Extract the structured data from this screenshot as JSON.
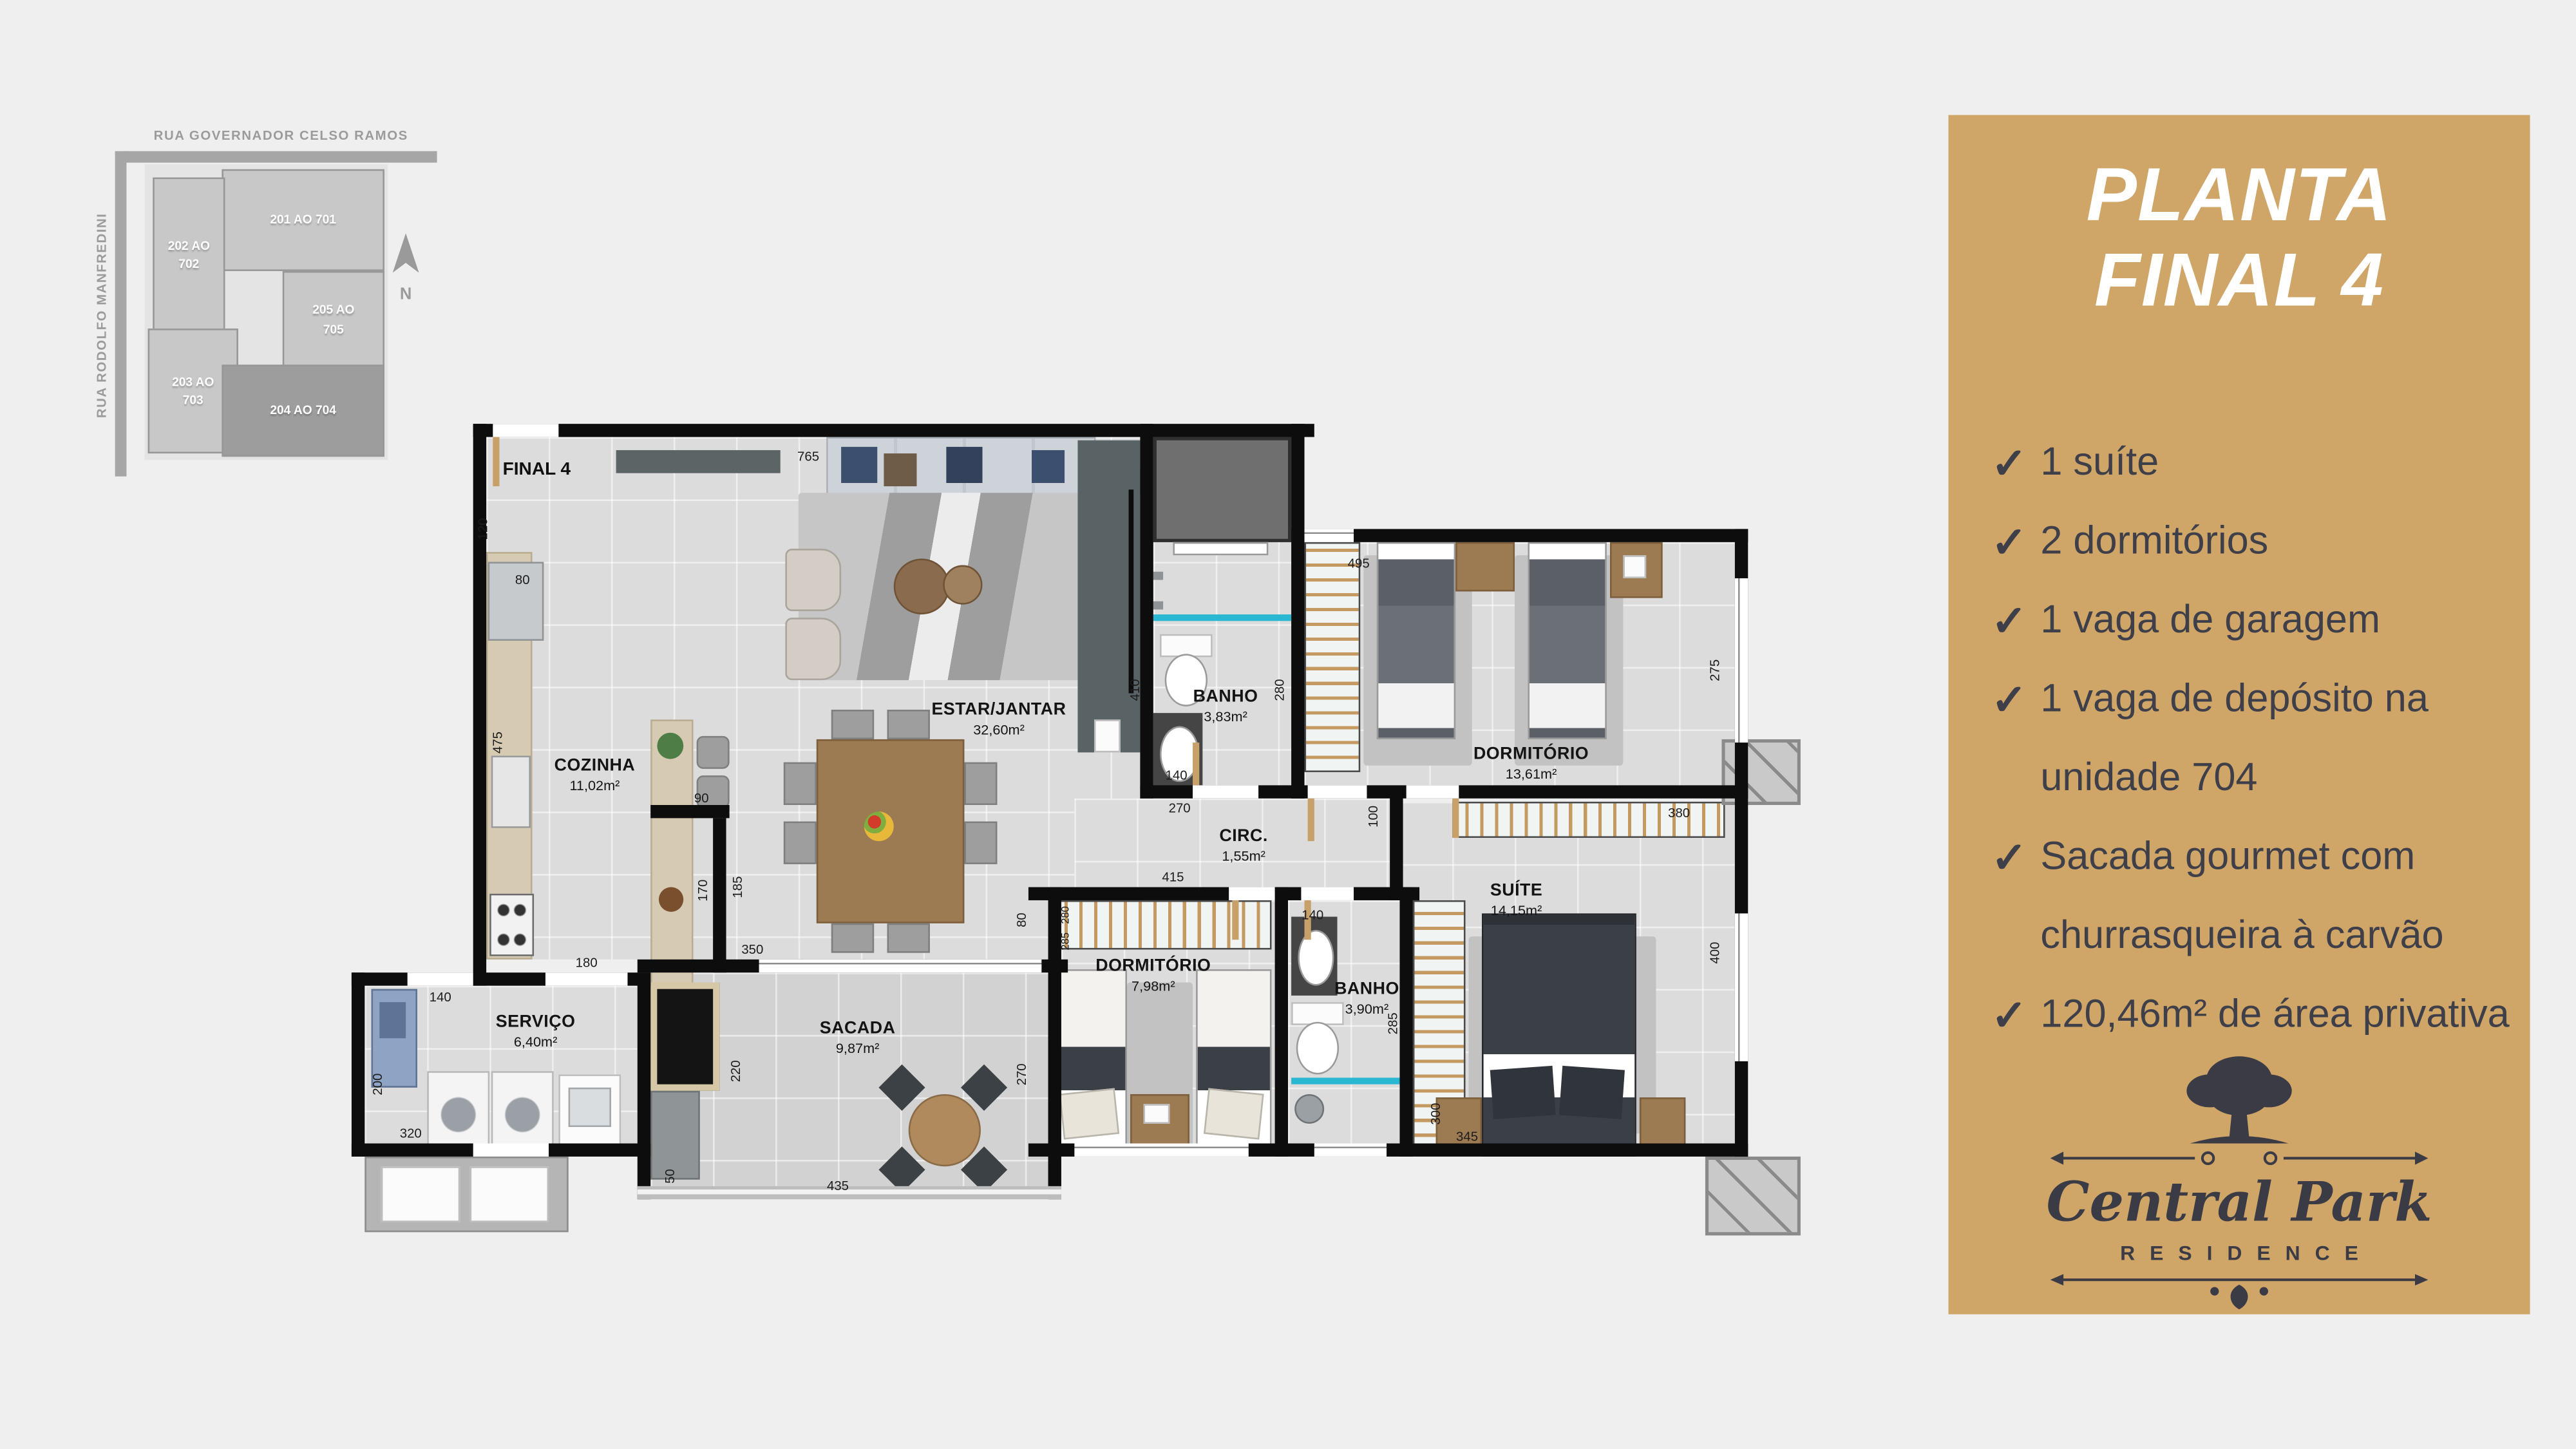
{
  "colors": {
    "panel_gold": "#cfa668",
    "logo_ink": "#3b3b46",
    "checklist_ink": "#3f3f49",
    "wall": "#0d0d0d"
  },
  "map": {
    "street_top": "RUA GOVERNADOR CELSO RAMOS",
    "street_left": "RUA RODOLFO MANFREDINI",
    "north_label": "N",
    "blocks": [
      {
        "label": "201 AO 701"
      },
      {
        "label": "202 AO 702"
      },
      {
        "label": "203 AO 703"
      },
      {
        "label": "204 AO 704"
      },
      {
        "label": "205 AO 705"
      }
    ]
  },
  "plan": {
    "unit_label": "FINAL 4",
    "rooms": [
      {
        "name": "COZINHA",
        "area": "11,02m²"
      },
      {
        "name": "ESTAR/JANTAR",
        "area": "32,60m²"
      },
      {
        "name": "BANHO",
        "area": "3,83m²"
      },
      {
        "name": "DORMITÓRIO",
        "area": "13,61m²"
      },
      {
        "name": "CIRC.",
        "area": "1,55m²"
      },
      {
        "name": "SUÍTE",
        "area": "14,15m²"
      },
      {
        "name": "DORMITÓRIO",
        "area": "7,98m²"
      },
      {
        "name": "BANHO",
        "area": "3,90m²"
      },
      {
        "name": "SERVIÇO",
        "area": "6,40m²"
      },
      {
        "name": "SACADA",
        "area": "9,87m²"
      }
    ],
    "dims": {
      "estar_top": "765",
      "left_top": "120",
      "fridge": "80",
      "counter": "475",
      "island_gap": "90",
      "island_len": "170",
      "island_wall": "185",
      "pass": "350",
      "kitchen_opening": "180",
      "servico_opening": "140",
      "servico_left": "200",
      "servico_bottom": "320",
      "grill": "220",
      "sacada_step": "50",
      "sacada_bottom": "435",
      "dorm2_left": "270",
      "estar_right": "410",
      "banho1_right": "280",
      "banho1_sink": "140",
      "circ_opening": "270",
      "dorm1_top": "495",
      "dorm1_right": "275",
      "circ_right": "100",
      "suite_rail": "380",
      "dorm2_top": "415",
      "dorm2_ward_depth": "80",
      "dorm2_ward_a": "280",
      "dorm2_ward_b": "285",
      "banho2_sink": "140",
      "banho2_right": "285",
      "suite_ward": "300",
      "suite_ward_len": "345",
      "suite_right": "400"
    }
  },
  "panel": {
    "title_line1": "PLANTA",
    "title_line2": "FINAL 4",
    "check_glyph": "✓",
    "features": [
      {
        "text": "1 suíte"
      },
      {
        "text": "2 dormitórios"
      },
      {
        "text": "1 vaga de garagem"
      },
      {
        "text": "1 vaga de depósito na unidade 704"
      },
      {
        "text": "Sacada gourmet com churrasqueira à carvão"
      },
      {
        "text": "120,46m² de área privativa"
      }
    ],
    "logo": {
      "name": "Central Park",
      "subtitle": "RESIDENCE"
    }
  }
}
